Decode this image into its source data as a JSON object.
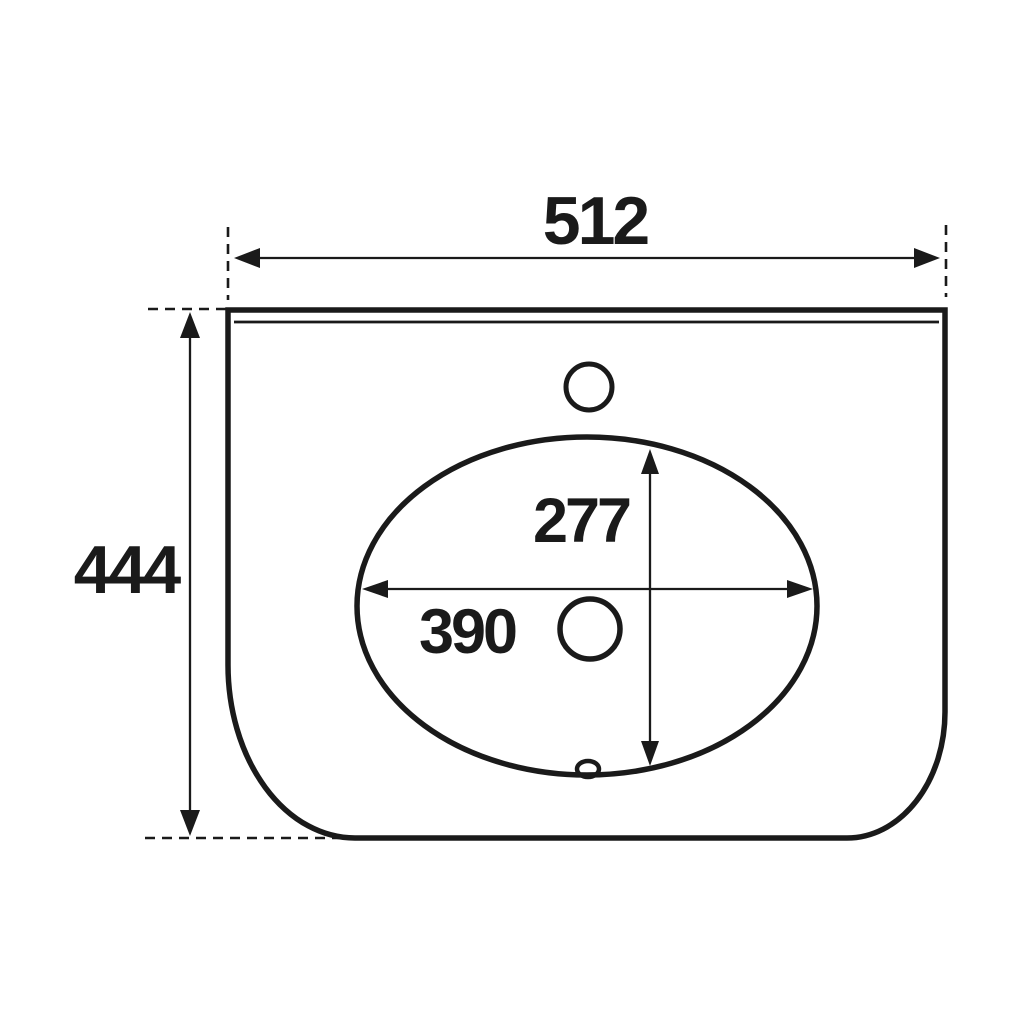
{
  "canvas": {
    "background": "#ffffff",
    "line_color": "#1a1a1a"
  },
  "drawing": {
    "dimensions": {
      "overall_width": "512",
      "overall_depth": "444",
      "bowl_depth": "277",
      "bowl_width": "390"
    }
  }
}
